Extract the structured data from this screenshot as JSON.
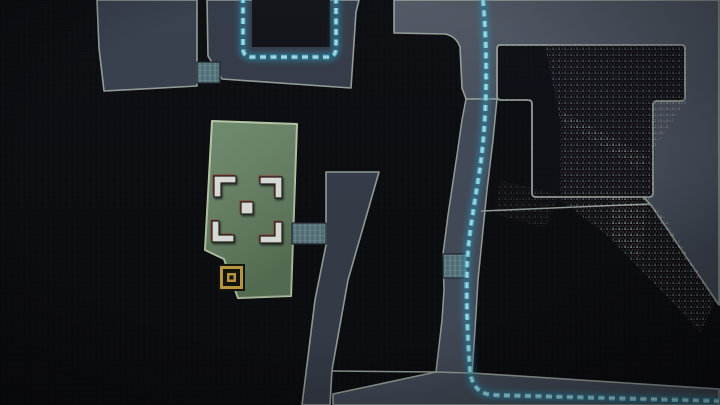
{
  "map": {
    "colors": {
      "background": "#0e0f13",
      "grid_line": "#07080b",
      "revealed_fill": "#49515f",
      "corridor_fill": "#3a414e",
      "room_fill": "#3e4654",
      "dark_room_fill": "#101117",
      "outline": "#a2aca6",
      "objective_room_fill": "#6e8e6b",
      "objective_room_outline": "#c7dcb5",
      "route_glow": "#2d9cc0",
      "route_main": "#6fd2e8",
      "route_core": "#bdeef8",
      "door_fill": "#5a7880",
      "door_line": "#8fb2b6",
      "door_outline": "#232b30",
      "marker_white": "#f1f2ed",
      "marker_fringe": "#9c4537",
      "marker_outline": "#26211c",
      "exit_gold": "#cda647",
      "exit_dark": "#15150e",
      "noise_light": "#ccd6d2",
      "noise_red": "#8c3434",
      "noise_teal": "#2e6b6b",
      "void_fill": "#14151a"
    },
    "markers": {
      "objective_marker": {
        "icon": "corner-brackets-target-icon"
      },
      "exit_marker": {
        "icon": "nested-gold-square-exit-icon"
      }
    },
    "doors": {
      "count": 3,
      "style": "hatched-grid-connector"
    },
    "route": {
      "style": "dashed-glow"
    }
  }
}
